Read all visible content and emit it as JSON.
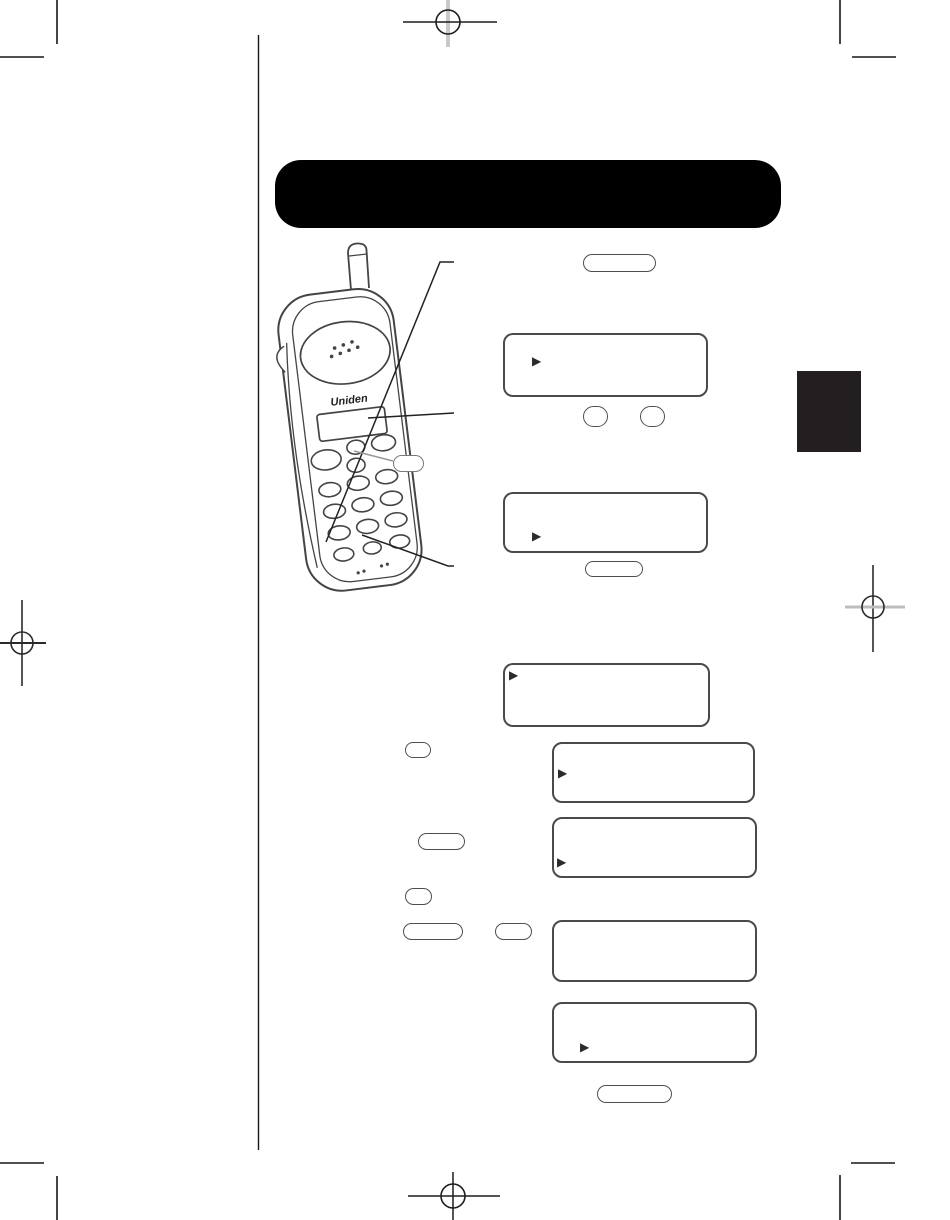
{
  "page": {
    "background": "#ffffff"
  },
  "header": {
    "title": "",
    "background": "#000000"
  },
  "section_tab": {
    "background": "#231f20"
  },
  "phone": {
    "brand": "Uniden"
  },
  "icons": {
    "lcd_cursor": "dot-matrix right arrow"
  },
  "displays": [
    {
      "name": "lcd-display-1",
      "cursor": "▶",
      "cursor_position": "upper-left"
    },
    {
      "name": "lcd-display-2",
      "cursor": "▶",
      "cursor_position": "lower-left"
    },
    {
      "name": "lcd-display-3",
      "cursor": "▶",
      "cursor_position": "upper-left"
    },
    {
      "name": "lcd-display-4",
      "cursor": "▶",
      "cursor_position": "middle-left"
    },
    {
      "name": "lcd-display-5",
      "cursor": "▶",
      "cursor_position": "lower-left"
    },
    {
      "name": "lcd-display-6",
      "cursor": "",
      "cursor_position": "none"
    },
    {
      "name": "lcd-display-7",
      "cursor": "▶",
      "cursor_position": "lower-left-indented"
    }
  ],
  "buttons": [
    {
      "name": "pill-button-top",
      "label": ""
    },
    {
      "name": "oval-button-a",
      "label": ""
    },
    {
      "name": "oval-button-b",
      "label": ""
    },
    {
      "name": "pill-button-2",
      "label": ""
    },
    {
      "name": "pill-button-figure-callout",
      "label": ""
    },
    {
      "name": "oval-button-c",
      "label": ""
    },
    {
      "name": "pill-button-3",
      "label": ""
    },
    {
      "name": "oval-button-d",
      "label": ""
    },
    {
      "name": "pill-button-4",
      "label": ""
    },
    {
      "name": "pill-button-small",
      "label": ""
    },
    {
      "name": "pill-button-bottom",
      "label": ""
    }
  ]
}
